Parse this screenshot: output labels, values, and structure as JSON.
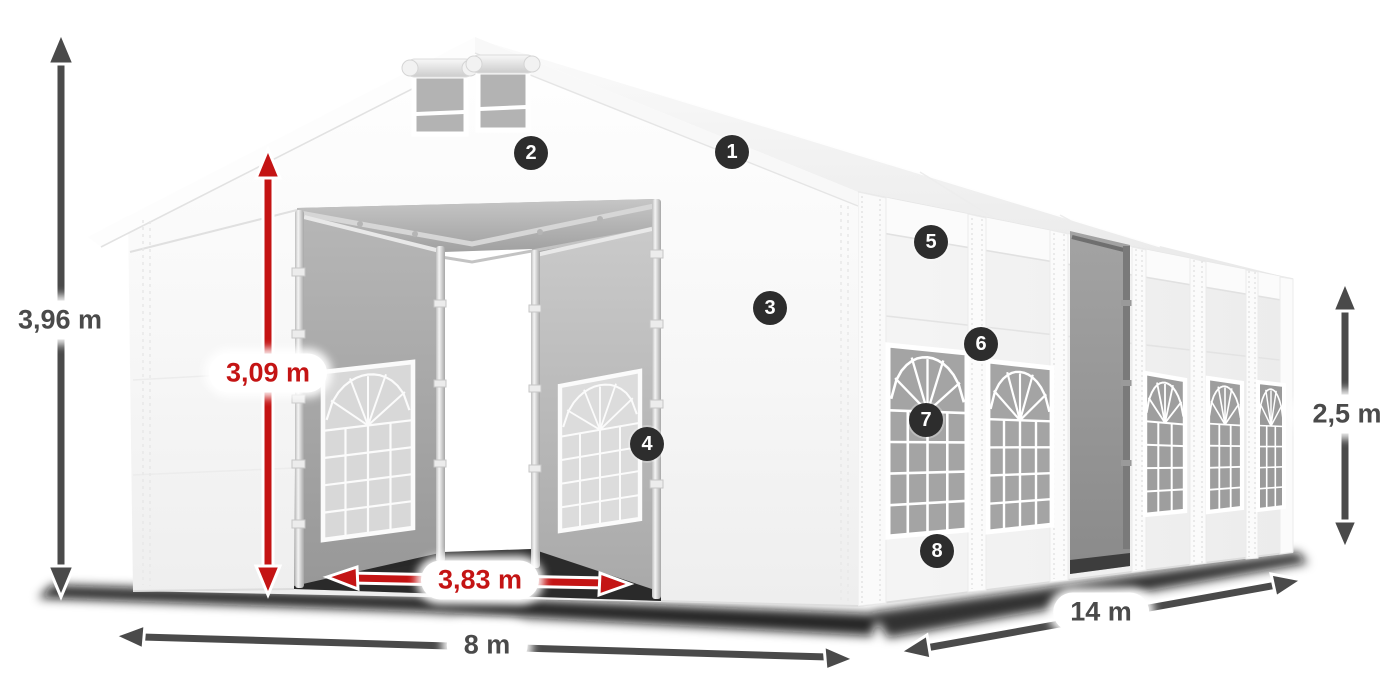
{
  "diagram": {
    "dimensions": {
      "total_height": {
        "label": "3,96 m",
        "color": "#4a4a4a"
      },
      "entrance_height": {
        "label": "3,09 m",
        "color": "#c41414"
      },
      "entrance_width": {
        "label": "3,83 m",
        "color": "#c41414"
      },
      "front_width": {
        "label": "8 m",
        "color": "#4a4a4a"
      },
      "side_length": {
        "label": "14 m",
        "color": "#4a4a4a"
      },
      "side_height": {
        "label": "2,5 m",
        "color": "#4a4a4a"
      }
    },
    "callouts": [
      {
        "number": "1"
      },
      {
        "number": "2"
      },
      {
        "number": "3"
      },
      {
        "number": "4"
      },
      {
        "number": "5"
      },
      {
        "number": "6"
      },
      {
        "number": "7"
      },
      {
        "number": "8"
      }
    ],
    "colors": {
      "badge_background": "#2d2d2d",
      "badge_text": "#ffffff",
      "dimension_red": "#c41414",
      "dimension_dark": "#4a4a4a",
      "tent_surface": "#f5f5f5",
      "window_pane": "#a6a6a6",
      "ground_shadow": "#101010"
    }
  }
}
